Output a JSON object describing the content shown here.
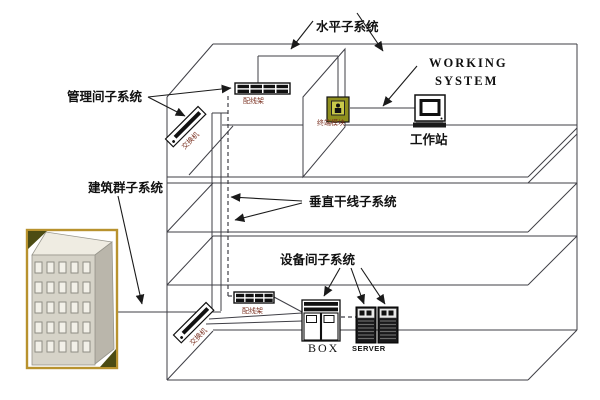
{
  "diagram": {
    "annotations": {
      "horizontal_subsystem": "水平子系统",
      "management_room_subsystem": "管理间子系统",
      "campus_subsystem": "建筑群子系统",
      "vertical_backbone_subsystem": "垂直干线子系统",
      "equipment_room_subsystem": "设备间子系统",
      "working_system_line1": "WORKING",
      "working_system_line2": "SYSTEM"
    },
    "devices": {
      "workstation": "工作站",
      "patch_panel_top": "配线架",
      "patch_panel_bottom": "配线架",
      "switch_top": "交换机",
      "switch_bottom": "交换机",
      "terminal_module": "终端模块",
      "box_cabinet": "BOX",
      "server": "SERVER"
    },
    "colors": {
      "line": "#3f3f46",
      "device_label": "#7b3222",
      "building_frame": "#b8922e",
      "building_front": "#d6d3c8",
      "building_top": "#efece2",
      "building_side": "#bab6ab",
      "building_corner": "#4c4c14",
      "terminal_box": "#8f8f1e"
    }
  }
}
